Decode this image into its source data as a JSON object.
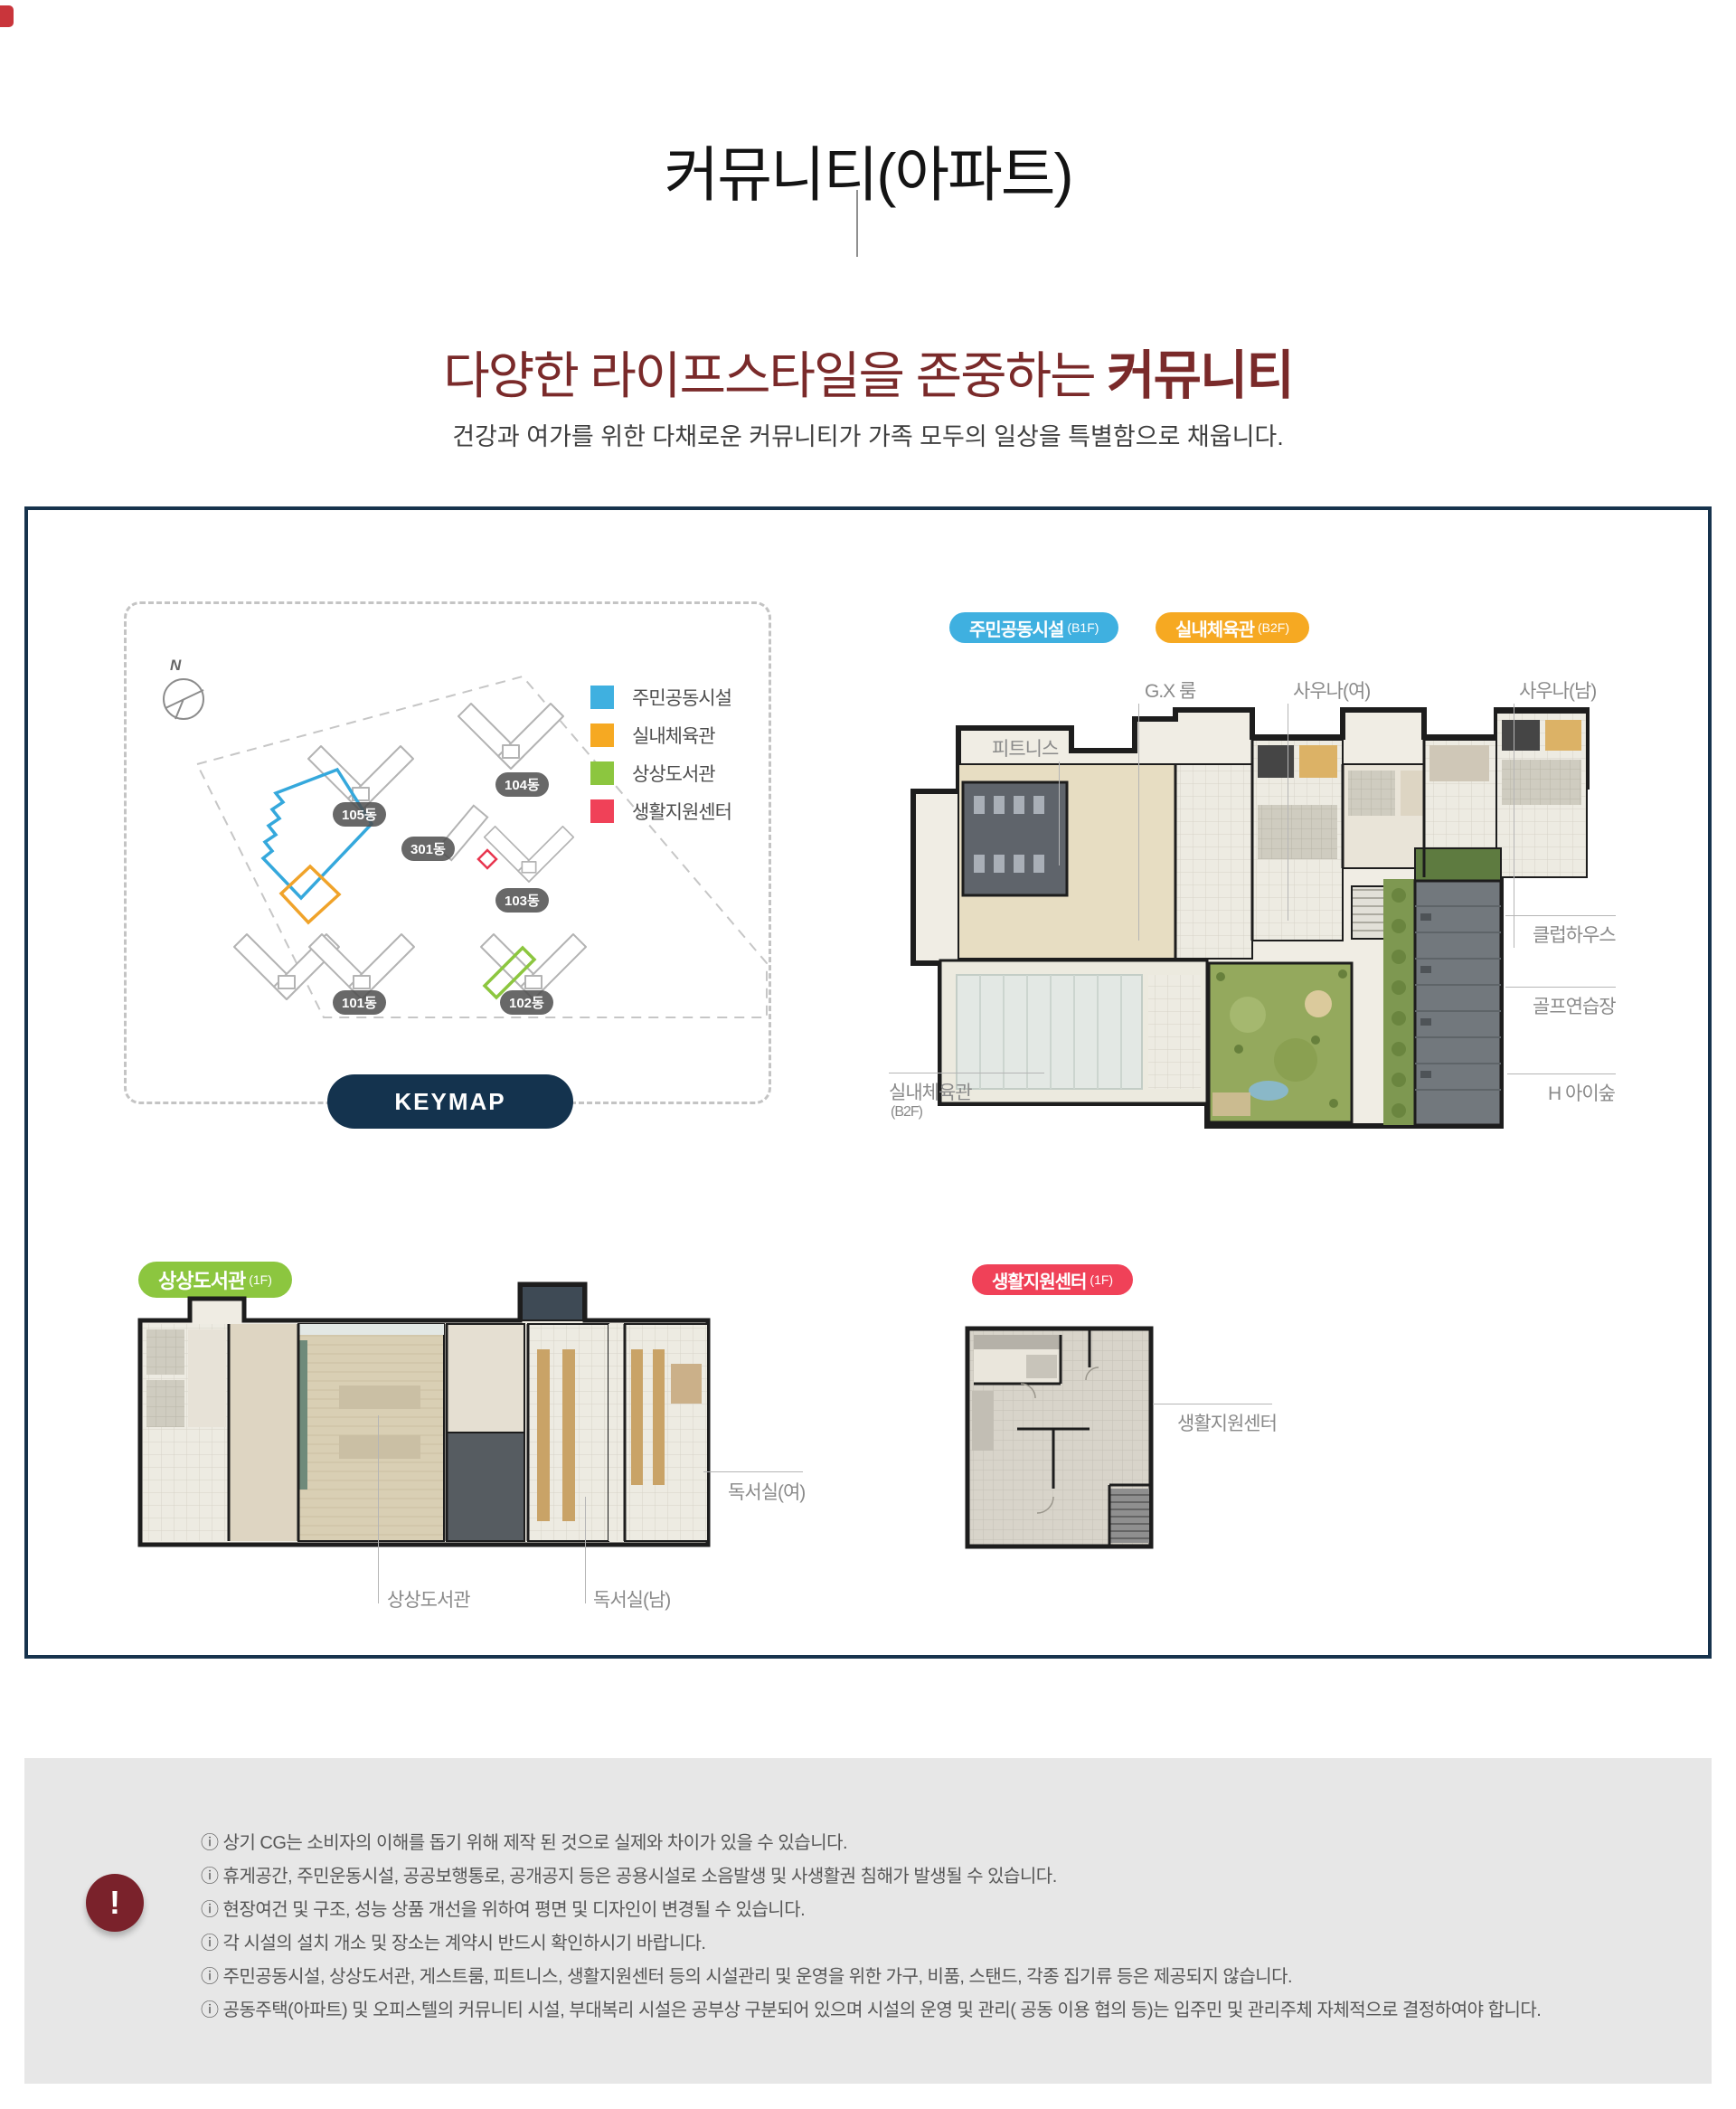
{
  "header": {
    "title": "커뮤니티(아파트)",
    "subtitle_prefix": "다양한 라이프스타일을 존중하는 ",
    "subtitle_emphasis": "커뮤니티",
    "description": "건강과 여가를 위한 다채로운 커뮤니티가 가족 모두의 일상을 특별함으로 채웁니다."
  },
  "colors": {
    "panel_border_navy": "#17334d",
    "keymap_button_navy": "#14334e",
    "subtitle_maroon": "#7a2a2a",
    "community_blue": "#3fb0e0",
    "gym_orange": "#f6a922",
    "library_green": "#8cc63f",
    "support_red": "#f04158",
    "notice_bg": "#e7e7e7",
    "warning_circle": "#7a222b"
  },
  "keymap": {
    "compass": "N",
    "button": "KEYMAP",
    "legend": [
      {
        "label": "주민공동시설",
        "color": "#3fb0e0"
      },
      {
        "label": "실내체육관",
        "color": "#f6a922"
      },
      {
        "label": "상상도서관",
        "color": "#8cc63f"
      },
      {
        "label": "생활지원센터",
        "color": "#f04158"
      }
    ],
    "buildings": [
      "105동",
      "104동",
      "301동",
      "103동",
      "101동",
      "102동"
    ]
  },
  "community_plan": {
    "badge_main": "주민공동시설",
    "badge_main_floor": "(B1F)",
    "badge_sub": "실내체육관",
    "badge_sub_floor": "(B2F)",
    "labels": {
      "fitness": "피트니스",
      "gx_room": "G.X 룸",
      "sauna_w": "사우나(여)",
      "sauna_m": "사우나(남)",
      "clubhouse": "클럽하우스",
      "golf": "골프연습장",
      "kids_forest": "H 아이숲",
      "indoor_gym": "실내체육관",
      "indoor_gym_floor": "(B2F)"
    }
  },
  "library_plan": {
    "badge": "상상도서관",
    "badge_floor": "(1F)",
    "labels": {
      "reading_w": "독서실(여)",
      "library": "상상도서관",
      "reading_m": "독서실(남)"
    }
  },
  "support_plan": {
    "badge": "생활지원센터",
    "badge_floor": "(1F)",
    "labels": {
      "support": "생활지원센터"
    }
  },
  "notice": {
    "icon": "!",
    "items": [
      "ⓘ 상기 CG는 소비자의 이해를 돕기 위해 제작 된 것으로 실제와 차이가 있을 수 있습니다.",
      "ⓘ 휴게공간, 주민운동시설, 공공보행통로, 공개공지 등은 공용시설로 소음발생 및 사생활권 침해가 발생될 수 있습니다.",
      "ⓘ 현장여건 및 구조, 성능 상품 개선을 위하여 평면 및 디자인이 변경될 수 있습니다.",
      "ⓘ 각 시설의 설치 개소 및 장소는 계약시 반드시 확인하시기 바랍니다.",
      "ⓘ 주민공동시설, 상상도서관, 게스트룸, 피트니스, 생활지원센터 등의 시설관리 및 운영을 위한 가구, 비품, 스탠드, 각종 집기류 등은 제공되지 않습니다.",
      "ⓘ 공동주택(아파트) 및 오피스텔의 커뮤니티 시설, 부대복리 시설은 공부상 구분되어 있으며 시설의 운영 및 관리( 공동 이용 협의 등)는 입주민 및 관리주체 자체적으로 결정하여야 합니다."
    ]
  }
}
